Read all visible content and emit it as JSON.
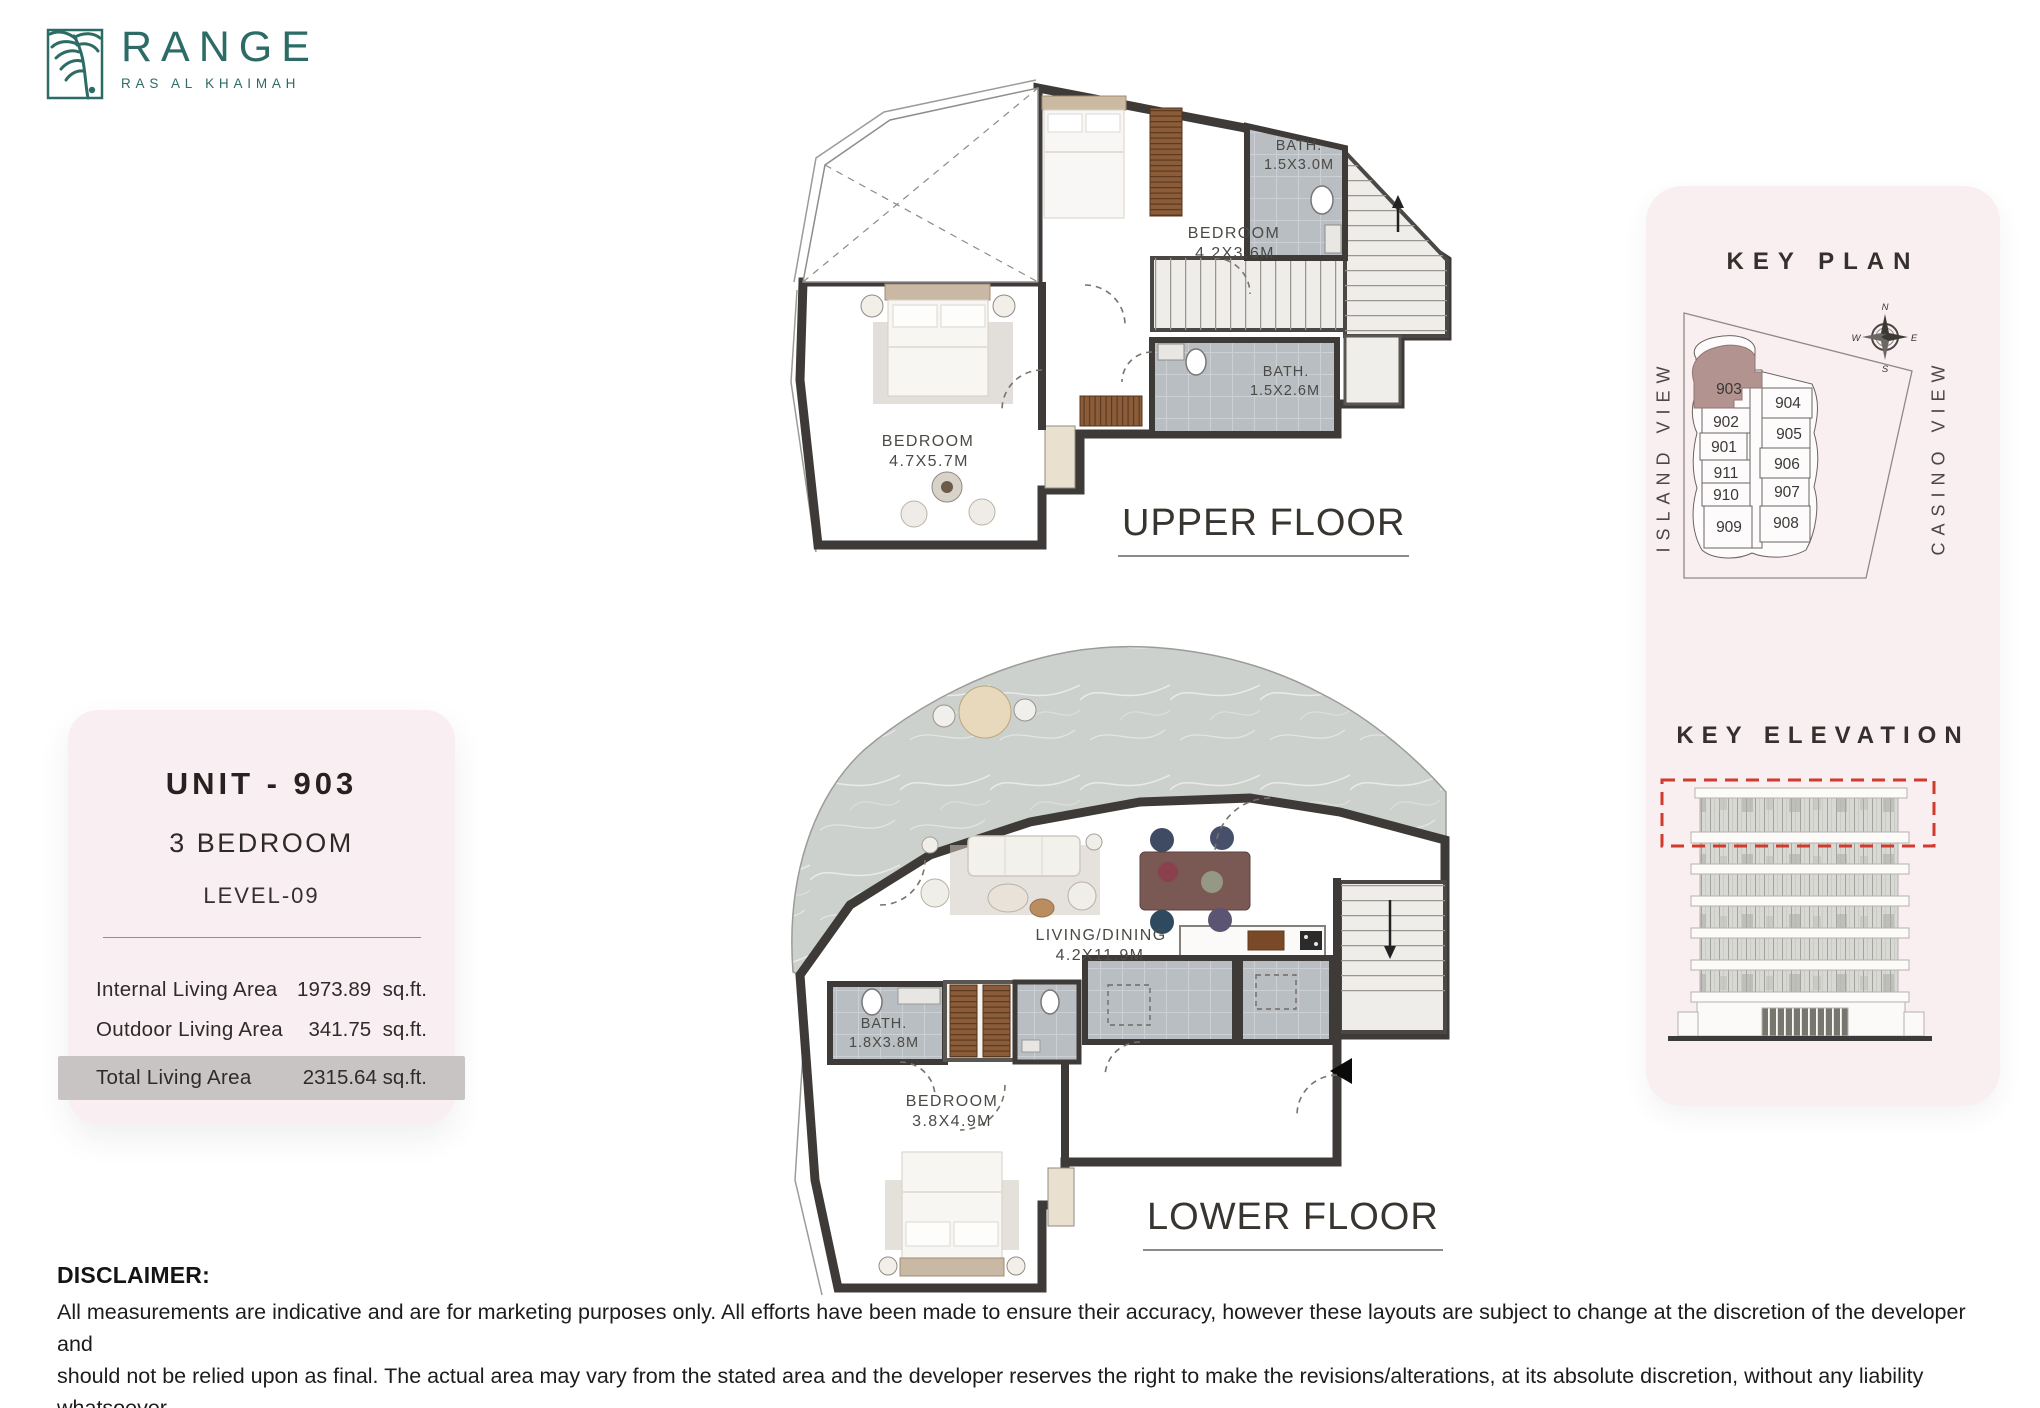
{
  "brand": {
    "name": "RANGE",
    "location": "RAS AL KHAIMAH"
  },
  "unit_card": {
    "title": "UNIT - 903",
    "type": "3 BEDROOM",
    "level": "LEVEL-09",
    "areas": [
      {
        "label": "Internal Living Area",
        "value": "1973.89",
        "unit": "sq.ft."
      },
      {
        "label": "Outdoor Living Area",
        "value": "341.75",
        "unit": "sq.ft."
      },
      {
        "label": "Total Living Area",
        "value": "2315.64",
        "unit": "sq.ft."
      }
    ]
  },
  "plans": {
    "upper": {
      "caption": "UPPER FLOOR",
      "rooms": [
        {
          "name": "BEDROOM",
          "dims": "4.2X3.6M"
        },
        {
          "name": "BATH.",
          "dims": "1.5X3.0M"
        },
        {
          "name": "BATH.",
          "dims": "1.5X2.6M"
        },
        {
          "name": "BEDROOM",
          "dims": "4.7X5.7M"
        }
      ]
    },
    "lower": {
      "caption": "LOWER FLOOR",
      "rooms": [
        {
          "name": "LIVING/DINING",
          "dims": "4.2X11.9M"
        },
        {
          "name": "BATH.",
          "dims": "1.8X3.8M"
        },
        {
          "name": "BEDROOM",
          "dims": "3.8X4.9M"
        }
      ]
    }
  },
  "key_plan": {
    "title": "KEY PLAN",
    "left_view": "ISLAND VIEW",
    "right_view": "CASINO VIEW",
    "compass": {
      "n": "N",
      "e": "E",
      "s": "S",
      "w": "W"
    },
    "highlight_unit": "903",
    "units": [
      {
        "id": "903"
      },
      {
        "id": "904"
      },
      {
        "id": "902"
      },
      {
        "id": "905"
      },
      {
        "id": "901"
      },
      {
        "id": "911"
      },
      {
        "id": "906"
      },
      {
        "id": "910"
      },
      {
        "id": "907"
      },
      {
        "id": "909"
      },
      {
        "id": "908"
      }
    ]
  },
  "key_elevation": {
    "title": "KEY ELEVATION"
  },
  "disclaimer": {
    "heading": "DISCLAIMER:",
    "line1": "All measurements are indicative and are for marketing purposes only. All efforts have been made to ensure their accuracy, however these layouts are subject to change at the discretion of the developer and",
    "line2": "should not be relied upon as final. The actual area may vary from the stated area and the developer reserves the right to make the revisions/alterations, at its absolute discretion, without any liability whatsoever"
  },
  "colors": {
    "accent": "#2c6b66",
    "highlight": "#b29390",
    "alert_red": "#cf3b2d"
  }
}
